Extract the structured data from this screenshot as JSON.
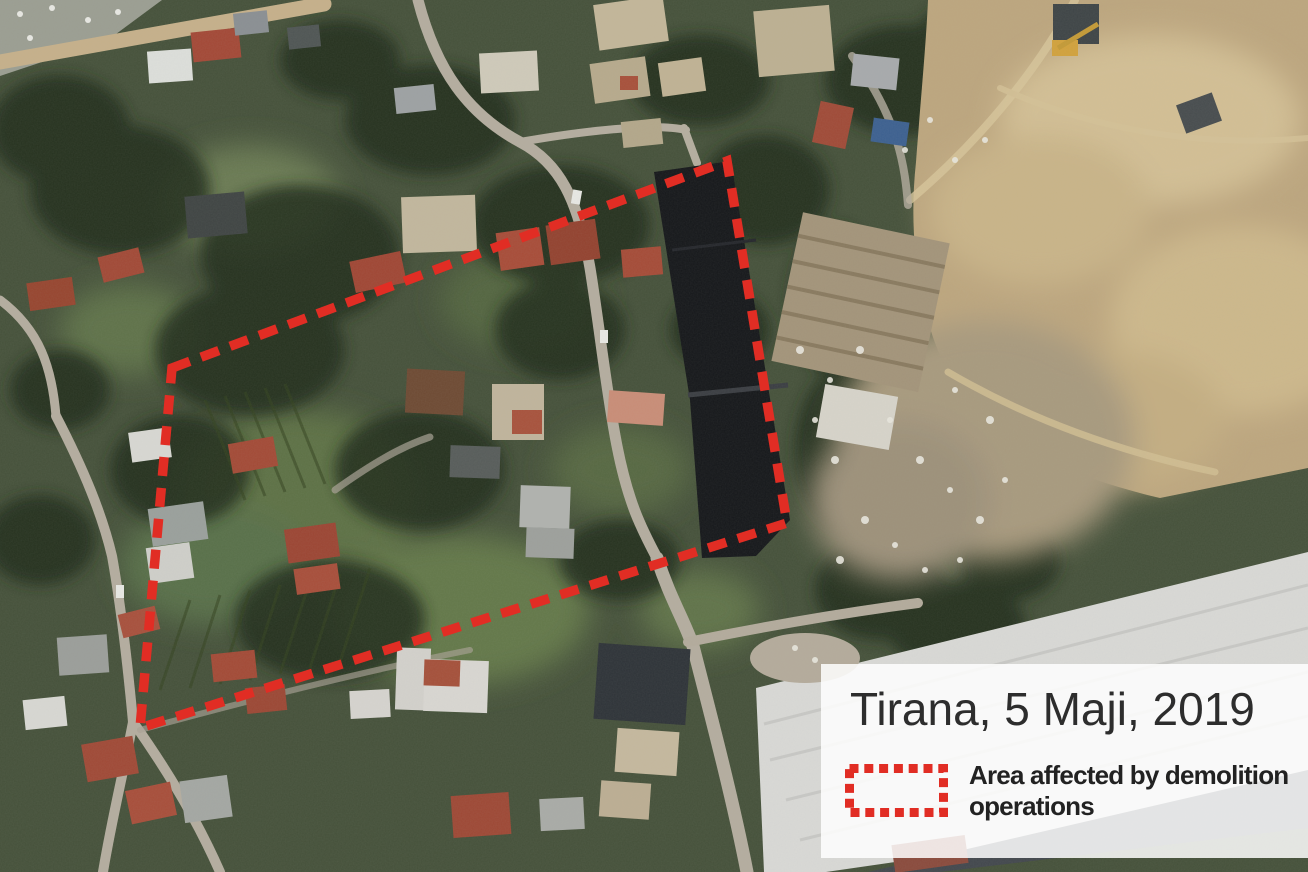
{
  "info_card": {
    "title": "Tirana, 5 Maji, 2019",
    "legend": {
      "label": "Area affected by demolition operations",
      "symbol": "red-dashed-rectangle"
    }
  },
  "annotation": {
    "label": "Area affected by demolition operations",
    "shape": "dashed-polygon",
    "color": "#e12d24",
    "points_px": [
      [
        172,
        368
      ],
      [
        727,
        161
      ],
      [
        787,
        523
      ],
      [
        140,
        728
      ]
    ]
  },
  "map": {
    "type": "satellite-imagery",
    "location": "Tirana",
    "date": "5 Maji, 2019"
  }
}
